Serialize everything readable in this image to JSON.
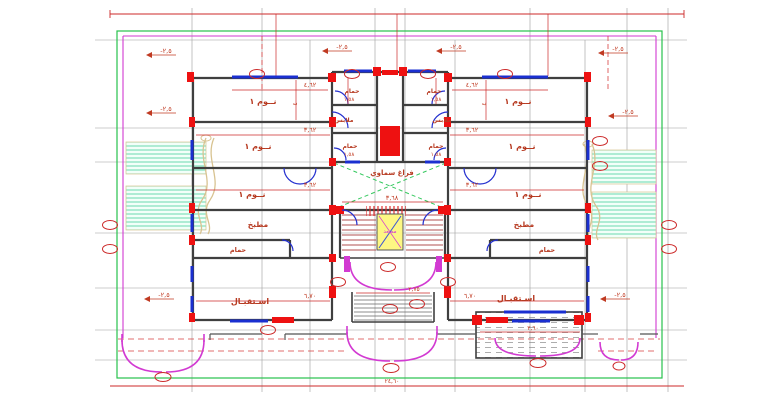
{
  "drawing": {
    "type": "architectural-floor-plan",
    "language": "Arabic",
    "rooms": {
      "bedroom": "نــوم ١",
      "kitchen": "مطبخ",
      "bathroom": "حمام",
      "closet": "ملابس",
      "reception": "اسـتقبـال",
      "lightwell": "فراغ سماوي",
      "elevator": "مصعد"
    },
    "dims": {
      "w_bed1": "٤,٦٢",
      "w_bed23": "٣,٦٢",
      "w_reception": "٦,٧٠",
      "w_lightwell": "٣,٦٨",
      "w_entry": "٢,٧٥",
      "w_bath": "١,٥٨",
      "w_terrace": "٣,٦٠",
      "h_bed": "٤",
      "total_width": "٢٤,٦٠"
    },
    "levels": {
      "ground": "-٢,٥"
    },
    "colors": {
      "wall": "#3f3f3f",
      "dimension_red": "#cc2a2a",
      "label_red": "#b73a21",
      "column_red": "#ee1111",
      "window_blue": "#1a2fd0",
      "grid_gray": "#9b9b9b",
      "boundary_green": "#27c24c",
      "boundary_magenta": "#d23ad2",
      "garden_hatch": "#5cd6a8",
      "path_tan": "#d8c391",
      "elevator_yellow": "#fdf783",
      "lightwell_green": "#35c95f"
    }
  }
}
